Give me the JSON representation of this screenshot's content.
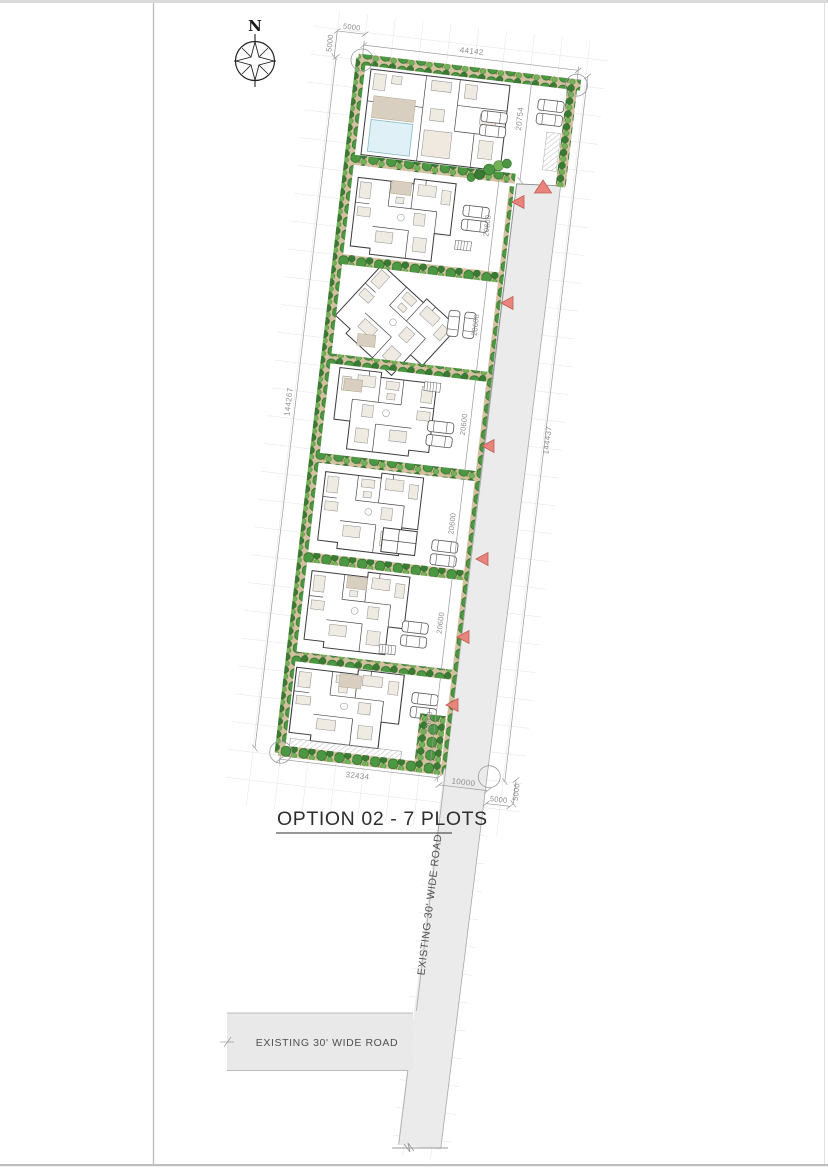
{
  "page": {
    "title": "OPTION 02 - 7 PLOTS"
  },
  "compass": {
    "north_label": "N"
  },
  "roads": {
    "vertical_road_label": "EXISTING 30' WIDE ROAD",
    "horizontal_road_label": "EXISTING 30' WIDE ROAD"
  },
  "dimensions": {
    "top_offset_horizontal": "5000",
    "top_offset_vertical": "5000",
    "top_edge_width": "44142",
    "plot1_depth": "20754",
    "east_boundary_total": "144437",
    "west_boundary_total": "144267",
    "plot_depths": [
      "20600",
      "20600",
      "20600",
      "20600",
      "20600",
      "20600"
    ],
    "bottom_edge_width": "32434",
    "road_width": "10000",
    "bottom_offset_horizontal": "5000",
    "bottom_offset_vertical": "5000"
  },
  "site": {
    "plot_count": 7,
    "entry_marker_count": 7
  },
  "colors": {
    "road_fill": "#e9e9e9",
    "entry_marker": "#e8847b",
    "tree": "#4c9742",
    "mulch": "#d2c19e",
    "patio": "#d9cfc0",
    "pool": "#dff0f7",
    "grid_line": "#e3e3e3",
    "dimension_text": "#8f8f8f"
  }
}
